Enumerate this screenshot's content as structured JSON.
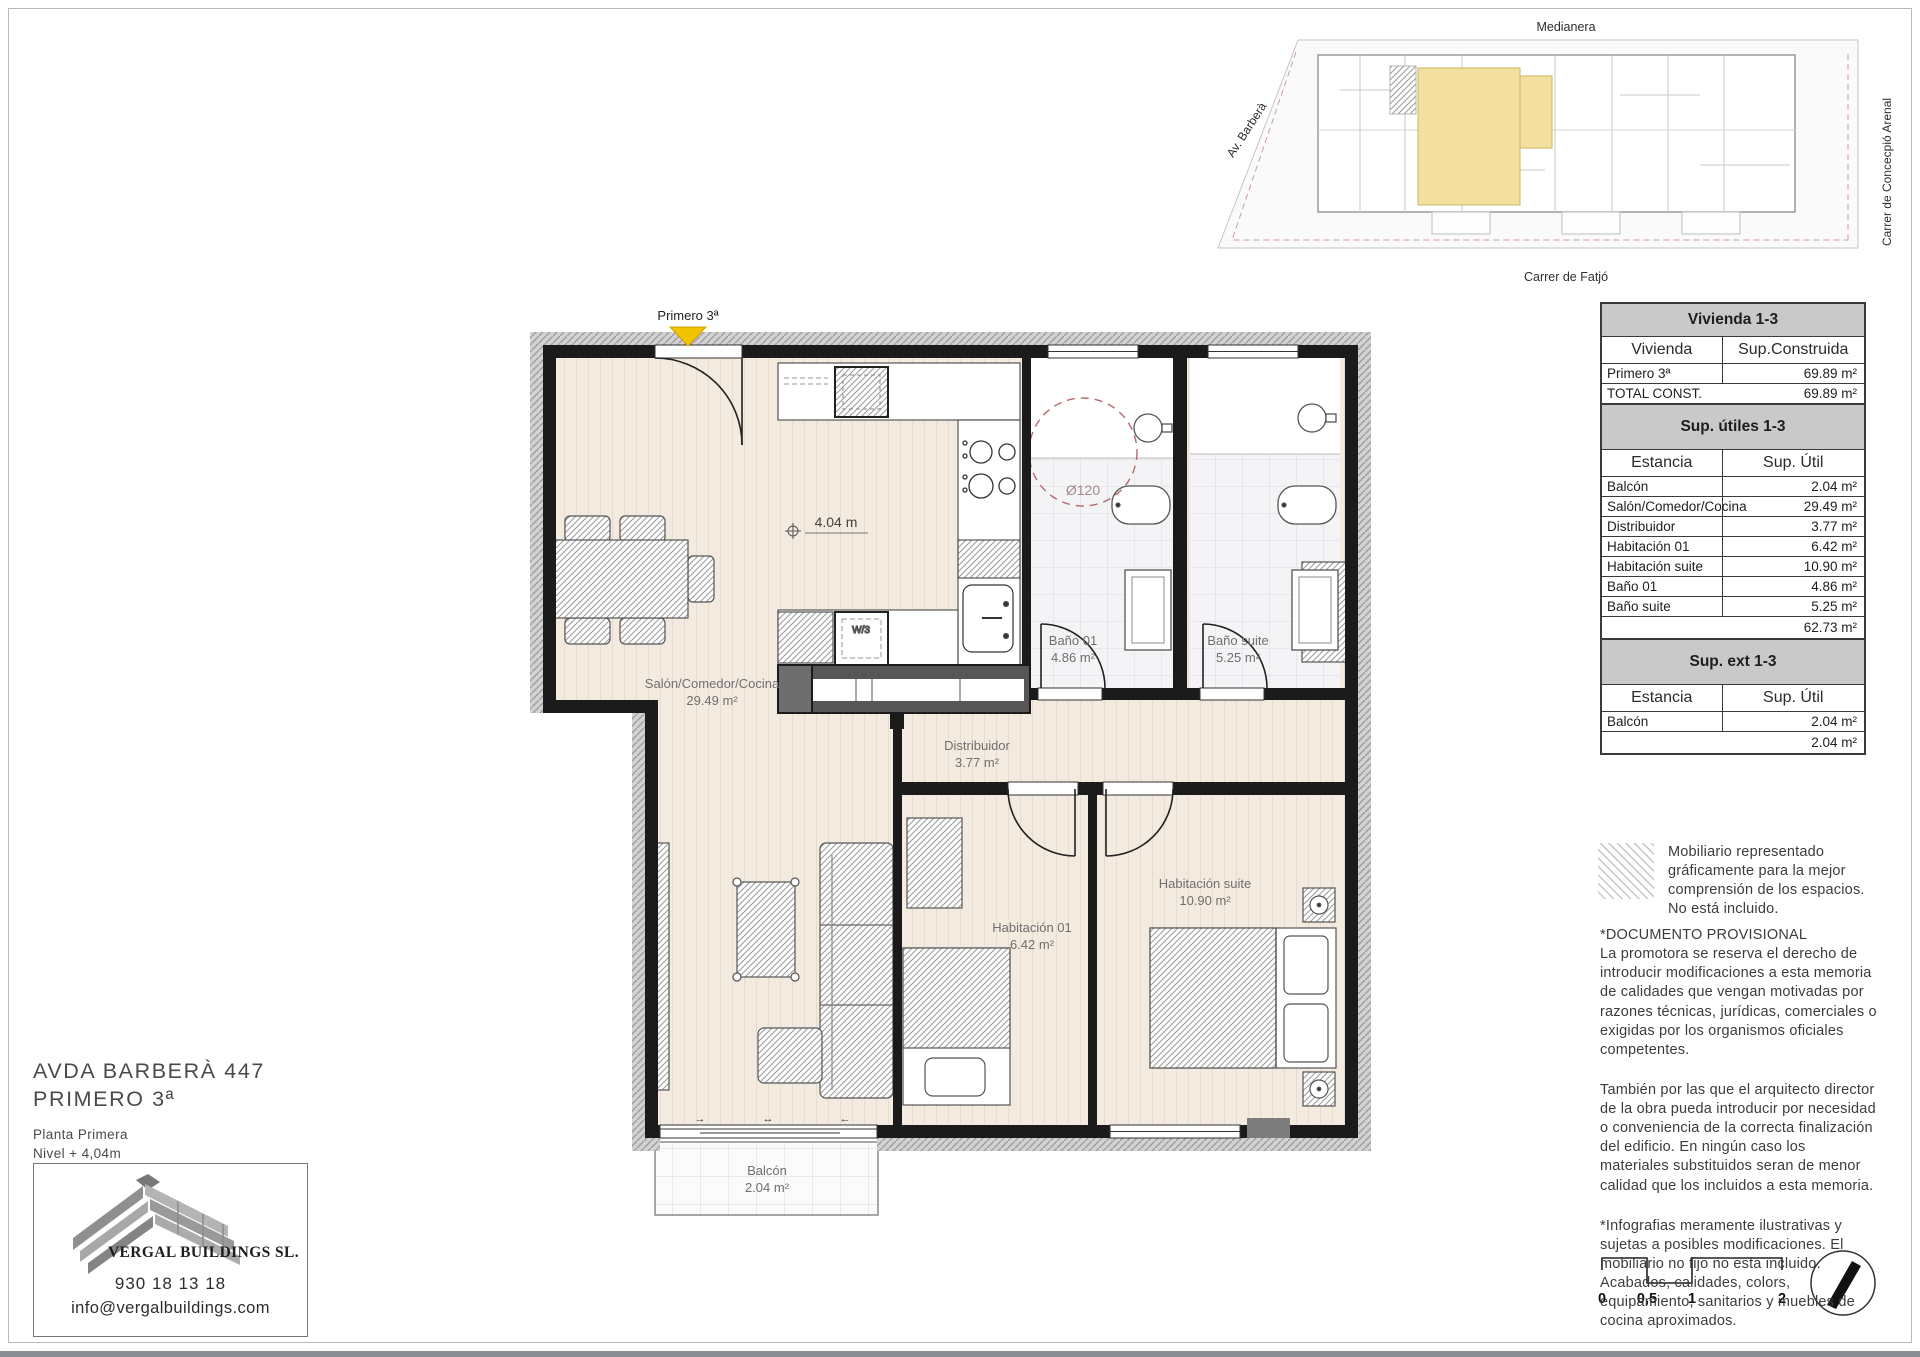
{
  "colors": {
    "floor_cream": "#f3eae0",
    "wall_black": "#1b1b1b",
    "hatch_grey": "#d2d2d2",
    "highlight_yellow": "#f3df9e",
    "marker_yellow": "#f2c400",
    "turning_circle_red": "#b46a6a",
    "table_header_grey": "#c9c9c9"
  },
  "address": {
    "line1": "AVDA BARBERÀ 447",
    "line2": "PRIMERO 3ª",
    "plan_level": "Planta Primera",
    "plan_height": "Nivel + 4,04m"
  },
  "company": {
    "name": "VERGAL BUILDINGS SL.",
    "phone": "930 18 13 18",
    "email": "info@vergalbuildings.com"
  },
  "site_plan": {
    "label_top": "Medianera",
    "label_left": "Av. Barberà",
    "label_right": "Carrer de Concecpió Arenal",
    "label_bottom": "Carrer de Fatjó"
  },
  "floor_plan": {
    "unit_label": "Primero 3ª",
    "level_marker": "4.04 m",
    "turning_circle": "Ø120",
    "washer_label": "W/3",
    "rooms": [
      {
        "name": "Salón/Comedor/Cocina",
        "area": "29.49 m²"
      },
      {
        "name": "Distribuidor",
        "area": "3.77 m²"
      },
      {
        "name": "Habitación 01",
        "area": "6.42 m²"
      },
      {
        "name": "Habitación suite",
        "area": "10.90 m²"
      },
      {
        "name": "Baño 01",
        "area": "4.86 m²"
      },
      {
        "name": "Baño suite",
        "area": "5.25 m²"
      },
      {
        "name": "Balcón",
        "area": "2.04 m²"
      }
    ]
  },
  "tables": {
    "vivienda": {
      "title": "Vivienda 1-3",
      "col1": "Vivienda",
      "col2": "Sup.Construida",
      "rows": [
        [
          "Primero 3ª",
          "69.89 m²"
        ],
        [
          "TOTAL CONST.",
          "69.89 m²"
        ]
      ]
    },
    "utiles": {
      "title": "Sup. útiles 1-3",
      "col1": "Estancia",
      "col2": "Sup. Útil",
      "rows": [
        [
          "Balcón",
          "2.04 m²"
        ],
        [
          "Salón/Comedor/Cocina",
          "29.49 m²"
        ],
        [
          "Distribuidor",
          "3.77 m²"
        ],
        [
          "Habitación 01",
          "6.42 m²"
        ],
        [
          "Habitación suite",
          "10.90 m²"
        ],
        [
          "Baño 01",
          "4.86 m²"
        ],
        [
          "Baño suite",
          "5.25 m²"
        ]
      ],
      "total": "62.73 m²"
    },
    "ext": {
      "title": "Sup. ext 1-3",
      "col1": "Estancia",
      "col2": "Sup. Útil",
      "rows": [
        [
          "Balcón",
          "2.04 m²"
        ]
      ],
      "total": "2.04 m²"
    }
  },
  "notes": {
    "mobiliario": "Mobiliario representado gráficamente para la mejor comprensión de los espacios. No está incluido.",
    "provisional_title": "*DOCUMENTO PROVISIONAL",
    "p1": "La promotora se reserva el derecho de introducir modificaciones a esta memoria de calidades que vengan motivadas por razones técnicas, jurídicas, comerciales o exigidas por los organismos oficiales competentes.",
    "p2": "También por las que el arquitecto director de la obra pueda introducir por necesidad o conveniencia de la correcta finalización del edificio. En ningún caso los materiales substituidos seran de menor calidad que los incluidos a esta memoria.",
    "p3": "*Infografias meramente ilustrativas y sujetas a posibles modificaciones. El mobiliario no fijo no esta incluido. Acabados, calidades, colors, equipamiento, sanitarios y muebles de cocina aproximados."
  },
  "scale_bar": {
    "l0": "0",
    "l1": "0,5",
    "l2": "1",
    "l3": "2"
  }
}
